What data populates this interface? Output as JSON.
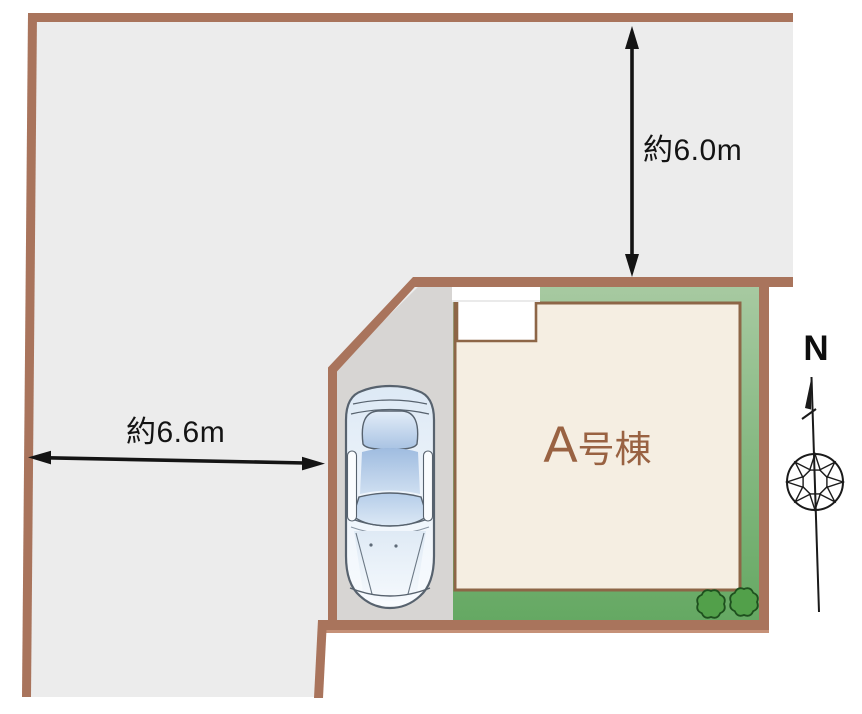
{
  "site_plan": {
    "building": {
      "label": "A号棟"
    },
    "dimensions": {
      "north_side": {
        "label": "約6.0m",
        "orientation": "vertical"
      },
      "west_side": {
        "label": "約6.6m",
        "orientation": "horizontal"
      }
    },
    "compass": {
      "label": "N"
    },
    "icons": {
      "compass": "compass-rose-north-icon",
      "car": "car-top-view-icon",
      "shrubs": "shrub-icon"
    },
    "colors": {
      "boundary_brown": "#a9745c",
      "building_outline": "#8d6647",
      "building_fill": "#f5eee2",
      "building_label_brown": "#996242",
      "lot_gray": "#ececec",
      "driveway_gray": "#d7d5d3",
      "garden_green_top": "#a8caa2",
      "garden_green_bottom": "#64a862",
      "shrub_green": "#52a04a",
      "dimension_black": "#141414"
    }
  }
}
